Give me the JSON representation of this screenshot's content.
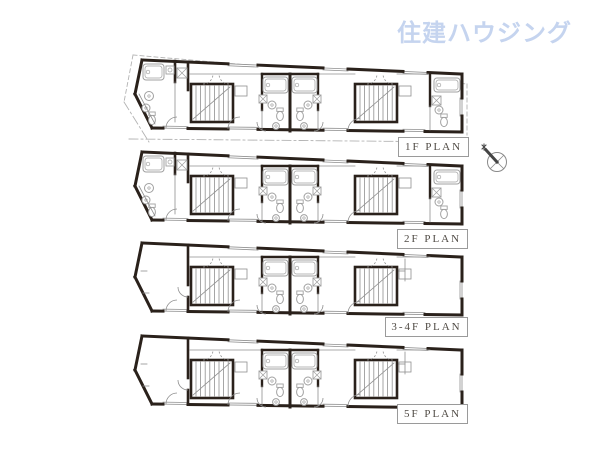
{
  "logo": {
    "text": "住建ハウジング",
    "color": "#c5d4ef"
  },
  "colors": {
    "wall": "#2a211b",
    "thin": "#8f8f8f",
    "fixture": "#a0a0a0",
    "boundary": "#b3b3b3",
    "label_text": "#504b45",
    "label_border": "#9a9a9a",
    "compass": "#444444",
    "background": "#ffffff"
  },
  "plans": [
    {
      "id": "1f",
      "label": "1F PLAN",
      "y": 58,
      "left_bath": true,
      "right_bath": true,
      "left_wall_full": false,
      "site_boundary": true
    },
    {
      "id": "2f",
      "label": "2F PLAN",
      "y": 150,
      "left_bath": true,
      "right_bath": true,
      "left_wall_full": false,
      "site_boundary": false
    },
    {
      "id": "3_4f",
      "label": "3-4F PLAN",
      "y": 241,
      "left_bath": false,
      "right_bath": false,
      "left_wall_full": true,
      "site_boundary": false
    },
    {
      "id": "5f",
      "label": "5F PLAN",
      "y": 334,
      "left_bath": false,
      "right_bath": false,
      "left_wall_full": true,
      "site_boundary": false
    }
  ],
  "north_arrow": {
    "name": "north-arrow",
    "direction": "north-west"
  }
}
